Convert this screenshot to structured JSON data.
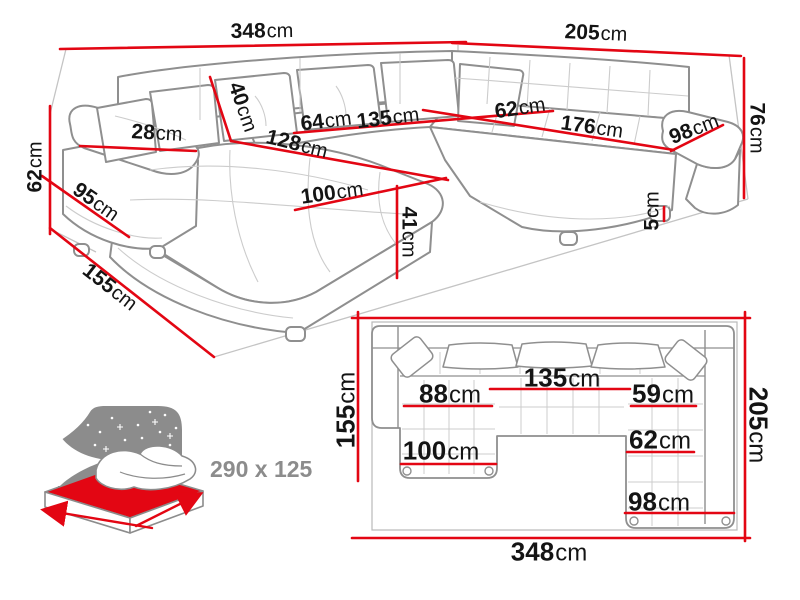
{
  "colors": {
    "dimension_red": "#e30613",
    "outline_gray": "#8f8f8f",
    "light_gray": "#cccccc",
    "muted_gray": "#8c8c8c",
    "text": "#141414"
  },
  "view3d": {
    "width_left_wall": {
      "num": "348",
      "unit": "cm"
    },
    "width_right_wall": {
      "num": "205",
      "unit": "cm"
    },
    "height_right": {
      "num": "76",
      "unit": "cm"
    },
    "height_left": {
      "num": "62",
      "unit": "cm"
    },
    "depth_left": {
      "num": "155",
      "unit": "cm"
    },
    "pillow_height": {
      "num": "40",
      "unit": "cm"
    },
    "armrest_width": {
      "num": "28",
      "unit": "cm"
    },
    "armrest_length": {
      "num": "95",
      "unit": "cm"
    },
    "seat_left": {
      "num": "64",
      "unit": "cm"
    },
    "seat_middle": {
      "num": "135",
      "unit": "cm"
    },
    "seat_right_depth": {
      "num": "62",
      "unit": "cm"
    },
    "seat_right_length": {
      "num": "176",
      "unit": "cm"
    },
    "right_arm_length": {
      "num": "98",
      "unit": "cm"
    },
    "chaise_length": {
      "num": "128",
      "unit": "cm"
    },
    "chaise_width": {
      "num": "100",
      "unit": "cm"
    },
    "seat_height": {
      "num": "41",
      "unit": "cm"
    },
    "leg_height": {
      "num": "5",
      "unit": "cm"
    }
  },
  "plan": {
    "depth_left": {
      "num": "155",
      "unit": "cm"
    },
    "depth_right": {
      "num": "205",
      "unit": "cm"
    },
    "width_bottom": {
      "num": "348",
      "unit": "cm"
    },
    "seat_middle": {
      "num": "135",
      "unit": "cm"
    },
    "seat_left": {
      "num": "88",
      "unit": "cm"
    },
    "seat_right_upper": {
      "num": "59",
      "unit": "cm"
    },
    "seat_right_lower": {
      "num": "62",
      "unit": "cm"
    },
    "chaise_width": {
      "num": "100",
      "unit": "cm"
    },
    "right_section_width": {
      "num": "98",
      "unit": "cm"
    }
  },
  "sleeping": {
    "label": "290 x 125"
  }
}
